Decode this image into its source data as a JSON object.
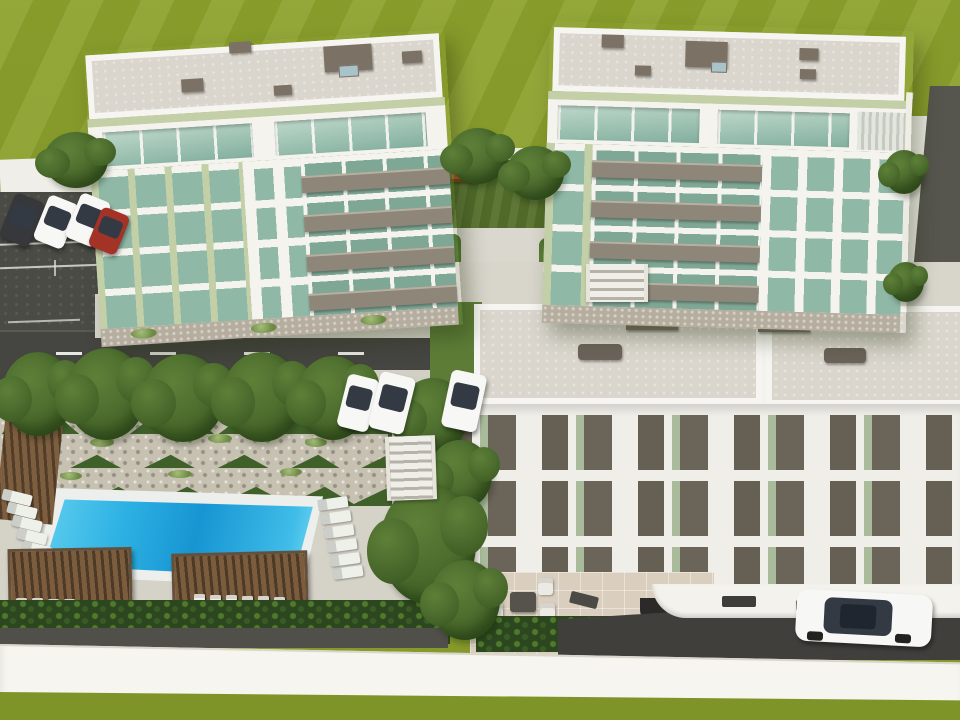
{
  "scene": {
    "type": "3d-architectural-rendering",
    "subject": "Aerial visualization of a residential complex: two five-storey apartment towers with green-glazed windows, a terraced low-rise block with roof terraces, street parking, landscaped courtyard, stone terraced garden and a rectangular swimming pool with pergolas",
    "left_tower": {
      "storeys": 5,
      "balcony_rows": 4,
      "glazing": "green tinted"
    },
    "right_tower": {
      "storeys": 5,
      "balcony_rows": 4,
      "glazing": "green tinted"
    },
    "low_rise_block": {
      "roof_terraces": 2,
      "visible_floor_bands": 3,
      "patio_chairs": 4
    },
    "pool": {
      "shape": "rectangular",
      "loungers_right": 6,
      "loungers_left": 5,
      "pergolas": 2,
      "pergola_chairs": 12
    },
    "courtyard": {
      "trees": 2,
      "benches": 2
    },
    "street_trees": 5,
    "vehicles": {
      "parking_row": [
        "dark-grey",
        "white",
        "white",
        "red"
      ],
      "street_parked": [
        "white",
        "white",
        "white"
      ],
      "driveway": [
        "white sedan"
      ]
    }
  },
  "palette": {
    "grassTop": "#8ea22e",
    "grassLow": "#7f9428",
    "courtLawn": "#55702c",
    "treeMid": "#5d8038",
    "treeDark": "#36551f",
    "hedge": "#2c471f",
    "asphalt": "#4b4b46",
    "road": "#454541",
    "pave": "#d5d2c8",
    "paveWarm": "#dacfbf",
    "walk": "#d8d5cb",
    "roofGray": "#dad6cd",
    "parapet": "#f6f5f1",
    "white": "#f4f3ee",
    "glass": "#8fb9a6",
    "glassDeep": "#7fa795",
    "sage": "#c3cfa6",
    "taupe": "#8e8678",
    "stone": "#c7c1b2",
    "stoneBase": "#b5ad9e",
    "poolDeep": "#1795d2",
    "poolLight": "#6fd6f2",
    "coping": "#edefec",
    "wood": "#7b5c3c",
    "woodGap": "#4c3a26",
    "roofBox": "#7b7164",
    "panelDark": "#665f54",
    "accentGreen": "#a9bb9b",
    "carDark": "#36383b",
    "carRed": "#a33327",
    "carWhite": "#f7f7f5",
    "glassCar": "#333a44",
    "wallWhite": "#f4f2ec",
    "driveDark": "#403f3b",
    "bench": "#b0652a",
    "furn": "#eceae5",
    "table": "#55534b",
    "umbrella": "#d8cbb2",
    "ramp": "#56554e",
    "sidegreen": "#5d7d37"
  }
}
